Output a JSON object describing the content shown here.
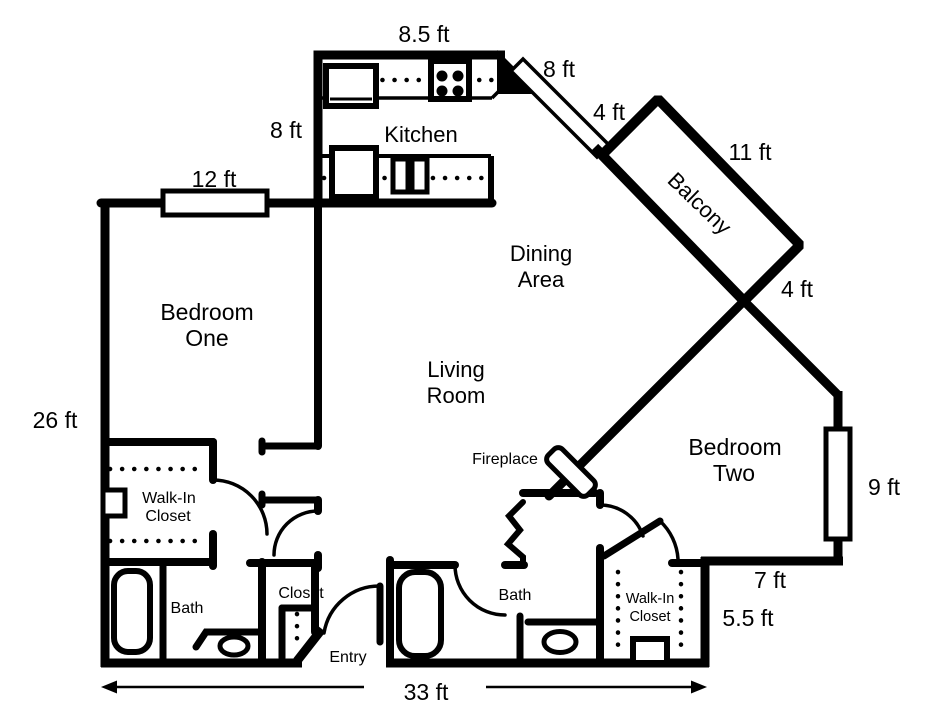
{
  "colors": {
    "ink": "#000000",
    "background": "#ffffff"
  },
  "rooms": {
    "kitchen": {
      "label": "Kitchen"
    },
    "dining_area": {
      "line1": "Dining",
      "line2": "Area"
    },
    "living_room": {
      "line1": "Living",
      "line2": "Room"
    },
    "bedroom_one": {
      "line1": "Bedroom",
      "line2": "One"
    },
    "bedroom_two": {
      "line1": "Bedroom",
      "line2": "Two"
    },
    "balcony": {
      "label": "Balcony"
    },
    "entry": {
      "label": "Entry"
    },
    "fireplace": {
      "label": "Fireplace"
    },
    "walk_in_closet_left": {
      "line1": "Walk-In",
      "line2": "Closet"
    },
    "walk_in_closet_right": {
      "line1": "Walk-In",
      "line2": "Closet"
    },
    "bath_left": {
      "label": "Bath"
    },
    "bath_main": {
      "label": "Bath"
    },
    "entry_closet": {
      "label": "Closet"
    }
  },
  "dimensions": {
    "kitchen_top": "8.5 ft",
    "balcony_door": "8 ft",
    "kitchen_west": "8 ft",
    "balcony_end_top": "4 ft",
    "balcony_side": "11 ft",
    "balcony_end_bottom": "4 ft",
    "bedroom_one_window": "12 ft",
    "west_wall": "26 ft",
    "bedroom_two_window": "9 ft",
    "bedroom_two_south": "7 ft",
    "closet_east_wall": "5.5 ft",
    "south_wall": "33 ft"
  },
  "fixtures": {
    "refrigerator": "refrigerator",
    "stove": "stove-cooktop-4-burners",
    "sink": "double-sink",
    "counter": "kitchen-counter-dotted",
    "bathtub": "bathtub",
    "toilet": "toilet",
    "window": "window",
    "door": "door-swing-arc",
    "closet_rod": "closet-rod-dotted",
    "fireplace": "fireplace-insert"
  }
}
